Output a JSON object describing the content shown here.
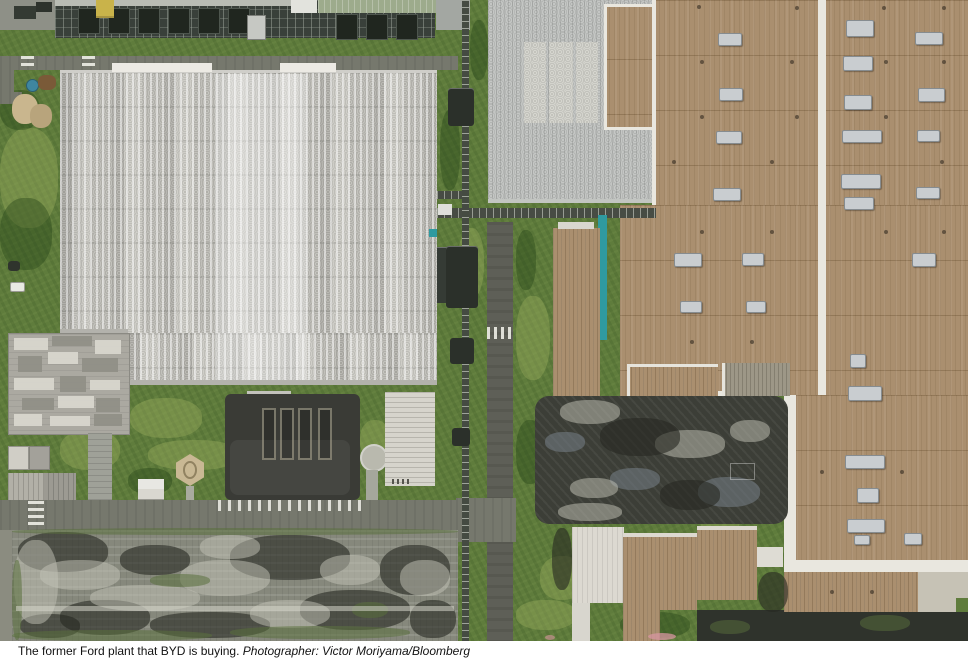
{
  "caption": {
    "text": "The former Ford plant that BYD is buying.",
    "credit": "Photographer: Victor Moriyama/Bloomberg"
  },
  "scene": {
    "colors": {
      "grass": "#5f7c3c",
      "whiteroof": "#dcdbd5",
      "tan": "#aa8f6f",
      "seam": "#e9e7df",
      "road": "#76786d",
      "roaddark": "#5e5f57",
      "asphalt": "#3c3e37",
      "lot": "#86887c",
      "hvac": "#c9cdd0",
      "teal": "#2f9aa0",
      "yellow": "#c9b34a"
    },
    "hvac_units": [
      [
        718,
        33,
        22,
        11
      ],
      [
        719,
        88,
        22,
        11
      ],
      [
        716,
        131,
        24,
        11
      ],
      [
        713,
        188,
        26,
        11
      ],
      [
        674,
        253,
        26,
        12
      ],
      [
        742,
        253,
        20,
        11
      ],
      [
        680,
        301,
        20,
        10
      ],
      [
        746,
        301,
        18,
        10
      ],
      [
        846,
        20,
        26,
        15
      ],
      [
        843,
        56,
        28,
        13
      ],
      [
        844,
        95,
        26,
        13
      ],
      [
        842,
        130,
        38,
        11
      ],
      [
        841,
        174,
        38,
        13
      ],
      [
        844,
        197,
        28,
        11
      ],
      [
        850,
        354,
        14,
        12
      ],
      [
        848,
        386,
        32,
        13
      ],
      [
        845,
        455,
        38,
        12
      ],
      [
        857,
        488,
        20,
        13
      ],
      [
        847,
        519,
        36,
        12
      ],
      [
        854,
        535,
        14,
        8
      ],
      [
        904,
        533,
        16,
        10
      ],
      [
        915,
        32,
        26,
        11
      ],
      [
        918,
        88,
        25,
        12
      ],
      [
        917,
        130,
        21,
        10
      ],
      [
        916,
        187,
        22,
        10
      ],
      [
        912,
        253,
        22,
        12
      ]
    ],
    "vents": [
      [
        697,
        5
      ],
      [
        795,
        6
      ],
      [
        882,
        6
      ],
      [
        942,
        6
      ],
      [
        700,
        60
      ],
      [
        790,
        60
      ],
      [
        884,
        60
      ],
      [
        942,
        60
      ],
      [
        700,
        115
      ],
      [
        795,
        115
      ],
      [
        884,
        115
      ],
      [
        672,
        160
      ],
      [
        770,
        160
      ],
      [
        940,
        160
      ],
      [
        700,
        230
      ],
      [
        770,
        230
      ],
      [
        884,
        230
      ],
      [
        942,
        230
      ],
      [
        690,
        340
      ],
      [
        750,
        340
      ],
      [
        820,
        470
      ],
      [
        900,
        470
      ],
      [
        830,
        590
      ],
      [
        870,
        590
      ]
    ],
    "top_modules": [
      [
        78,
        8
      ],
      [
        108,
        8
      ],
      [
        138,
        8
      ],
      [
        168,
        8
      ],
      [
        198,
        8
      ],
      [
        228,
        8
      ],
      [
        336,
        14
      ],
      [
        366,
        14
      ],
      [
        396,
        14
      ]
    ],
    "roof_patches": [
      [
        14,
        338,
        34,
        12,
        "l"
      ],
      [
        52,
        336,
        40,
        10,
        "d"
      ],
      [
        95,
        340,
        26,
        14,
        "l"
      ],
      [
        18,
        356,
        24,
        16,
        "d"
      ],
      [
        48,
        352,
        30,
        12,
        "l"
      ],
      [
        82,
        358,
        36,
        14,
        "d"
      ],
      [
        14,
        378,
        40,
        12,
        "l"
      ],
      [
        60,
        376,
        26,
        16,
        "d"
      ],
      [
        90,
        380,
        30,
        10,
        "l"
      ],
      [
        22,
        398,
        32,
        12,
        "d"
      ],
      [
        58,
        396,
        36,
        12,
        "l"
      ],
      [
        96,
        398,
        24,
        14,
        "d"
      ],
      [
        14,
        414,
        28,
        12,
        "l"
      ],
      [
        50,
        416,
        40,
        10,
        "l"
      ],
      [
        94,
        414,
        28,
        12,
        "d"
      ]
    ],
    "parking_bars": [
      [
        262,
        408
      ],
      [
        280,
        408
      ],
      [
        298,
        408
      ],
      [
        318,
        408
      ]
    ],
    "hroad_dashes": [
      [
        20,
        511
      ],
      [
        56,
        511
      ],
      [
        92,
        511
      ],
      [
        128,
        511
      ],
      [
        164,
        511
      ],
      [
        200,
        511
      ],
      [
        272,
        511
      ],
      [
        308,
        511
      ],
      [
        344,
        511
      ],
      [
        380,
        511
      ],
      [
        416,
        511
      ]
    ],
    "vroad_dashes": [
      [
        499,
        240
      ],
      [
        499,
        275
      ],
      [
        499,
        310
      ],
      [
        499,
        355
      ],
      [
        499,
        390
      ],
      [
        499,
        425
      ],
      [
        499,
        460
      ],
      [
        499,
        545
      ],
      [
        499,
        580
      ],
      [
        499,
        615
      ]
    ],
    "lot_blotches": [
      [
        18,
        532,
        90,
        40,
        "d"
      ],
      [
        120,
        545,
        70,
        30,
        "d"
      ],
      [
        230,
        535,
        120,
        45,
        "d"
      ],
      [
        300,
        590,
        110,
        40,
        "d"
      ],
      [
        60,
        600,
        90,
        35,
        "d"
      ],
      [
        380,
        545,
        70,
        50,
        "d"
      ],
      [
        150,
        612,
        120,
        26,
        "d"
      ],
      [
        20,
        614,
        60,
        24,
        "d"
      ],
      [
        410,
        600,
        46,
        38,
        "d"
      ],
      [
        40,
        560,
        80,
        30,
        "l"
      ],
      [
        180,
        560,
        90,
        36,
        "l"
      ],
      [
        320,
        555,
        60,
        30,
        "l"
      ],
      [
        90,
        585,
        110,
        26,
        "l"
      ],
      [
        250,
        600,
        80,
        28,
        "l"
      ],
      [
        400,
        560,
        50,
        36,
        "l"
      ],
      [
        14,
        540,
        44,
        84,
        "l"
      ],
      [
        200,
        535,
        60,
        24,
        "l"
      ],
      [
        12,
        528,
        446,
        7,
        "m"
      ],
      [
        12,
        630,
        200,
        11,
        "m"
      ],
      [
        230,
        626,
        180,
        13,
        "m"
      ],
      [
        150,
        574,
        60,
        13,
        "m"
      ],
      [
        352,
        602,
        36,
        16,
        "m"
      ],
      [
        12,
        560,
        10,
        80,
        "m"
      ]
    ],
    "asphalt_blotches": [
      [
        698,
        477,
        62,
        30,
        "b"
      ],
      [
        610,
        468,
        50,
        22,
        "b"
      ],
      [
        545,
        432,
        40,
        20,
        "b"
      ],
      [
        560,
        400,
        60,
        24,
        "l"
      ],
      [
        655,
        430,
        70,
        28,
        "l"
      ],
      [
        570,
        478,
        48,
        20,
        "l"
      ],
      [
        730,
        420,
        40,
        22,
        "l"
      ],
      [
        558,
        503,
        64,
        18,
        "l"
      ],
      [
        600,
        418,
        80,
        38,
        "d"
      ],
      [
        660,
        480,
        60,
        30,
        "d"
      ],
      [
        758,
        572,
        30,
        40,
        "d"
      ],
      [
        552,
        528,
        20,
        62,
        "d"
      ]
    ],
    "grass_patches": [
      [
        0,
        128,
        58,
        100,
        "l"
      ],
      [
        130,
        398,
        72,
        40,
        "l"
      ],
      [
        148,
        440,
        92,
        30,
        "l"
      ],
      [
        458,
        228,
        26,
        70,
        "l"
      ],
      [
        516,
        296,
        34,
        84,
        "l"
      ],
      [
        540,
        556,
        44,
        44,
        "l"
      ],
      [
        60,
        430,
        60,
        40,
        "l"
      ],
      [
        360,
        420,
        30,
        40,
        "l"
      ],
      [
        516,
        600,
        60,
        30,
        "l"
      ],
      [
        700,
        505,
        40,
        30,
        "l"
      ],
      [
        60,
        388,
        64,
        28,
        "d"
      ],
      [
        0,
        198,
        52,
        72,
        "d"
      ],
      [
        516,
        420,
        28,
        64,
        "d"
      ],
      [
        128,
        468,
        44,
        26,
        "d"
      ],
      [
        620,
        612,
        70,
        26,
        "d"
      ],
      [
        0,
        90,
        40,
        40,
        "d"
      ],
      [
        440,
        110,
        20,
        80,
        "d"
      ],
      [
        470,
        20,
        18,
        60,
        "d"
      ],
      [
        516,
        230,
        20,
        60,
        "d"
      ]
    ]
  }
}
